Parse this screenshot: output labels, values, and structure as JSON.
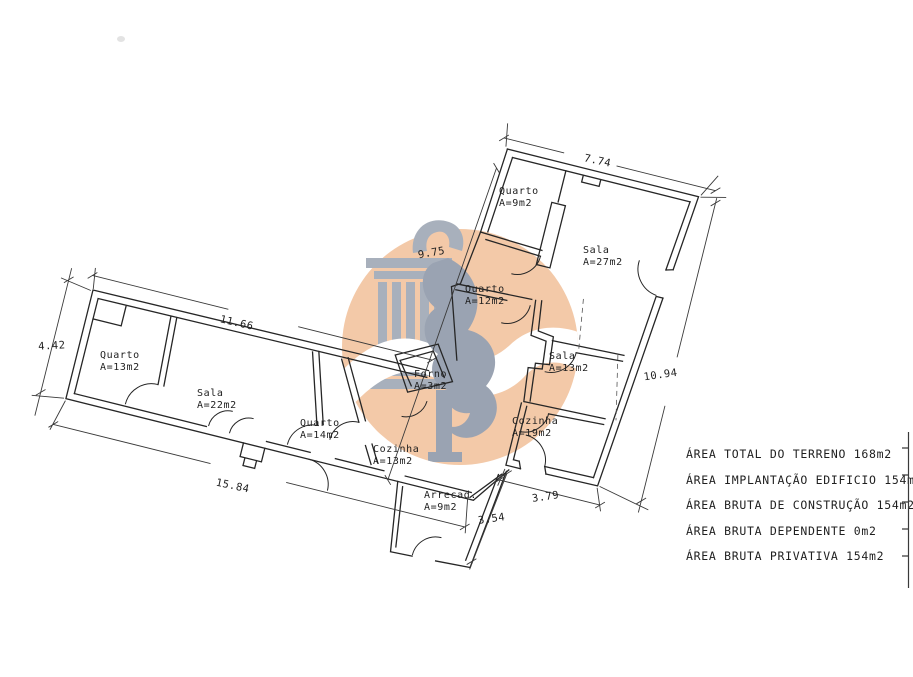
{
  "watermark": {
    "circle_color": "#f3c9a8",
    "logo_color": "#a8b0bc",
    "tail_color": "#9aa3b2",
    "wave_color": "#ffffff"
  },
  "rooms": [
    {
      "id": "quarto-13",
      "name": "Quarto",
      "area": "A=13m2"
    },
    {
      "id": "sala-22",
      "name": "Sala",
      "area": "A=22m2"
    },
    {
      "id": "quarto-14",
      "name": "Quarto",
      "area": "A=14m2"
    },
    {
      "id": "cozinha-13",
      "name": "Cozinha",
      "area": "A=13m2"
    },
    {
      "id": "arrecad-9",
      "name": "Arrecad.",
      "area": "A=9m2"
    },
    {
      "id": "forno-3",
      "name": "Forno",
      "area": "A=3m2"
    },
    {
      "id": "quarto-9",
      "name": "Quarto",
      "area": "A=9m2"
    },
    {
      "id": "sala-27",
      "name": "Sala",
      "area": "A=27m2"
    },
    {
      "id": "quarto-12",
      "name": "Quarto",
      "area": "A=12m2"
    },
    {
      "id": "sala-13",
      "name": "Sala",
      "area": "A=13m2"
    },
    {
      "id": "cozinha-19",
      "name": "Cozinha",
      "area": "A=19m2"
    }
  ],
  "dimensions": {
    "left_height": "4.42",
    "left_top": "11.66",
    "left_bottom": "15.84",
    "middle": "9.75",
    "right_top": "7.74",
    "right_side": "10.94",
    "annex_side": "3.54",
    "right_bottom": "3.79"
  },
  "area_summary": [
    "ÁREA TOTAL DO TERRENO 168m2",
    "ÁREA IMPLANTAÇÃO EDIFICIO 154m2",
    "ÁREA BRUTA DE CONSTRUÇÃO 154m2",
    "ÁREA BRUTA DEPENDENTE 0m2",
    "ÁREA BRUTA PRIVATIVA 154m2"
  ]
}
